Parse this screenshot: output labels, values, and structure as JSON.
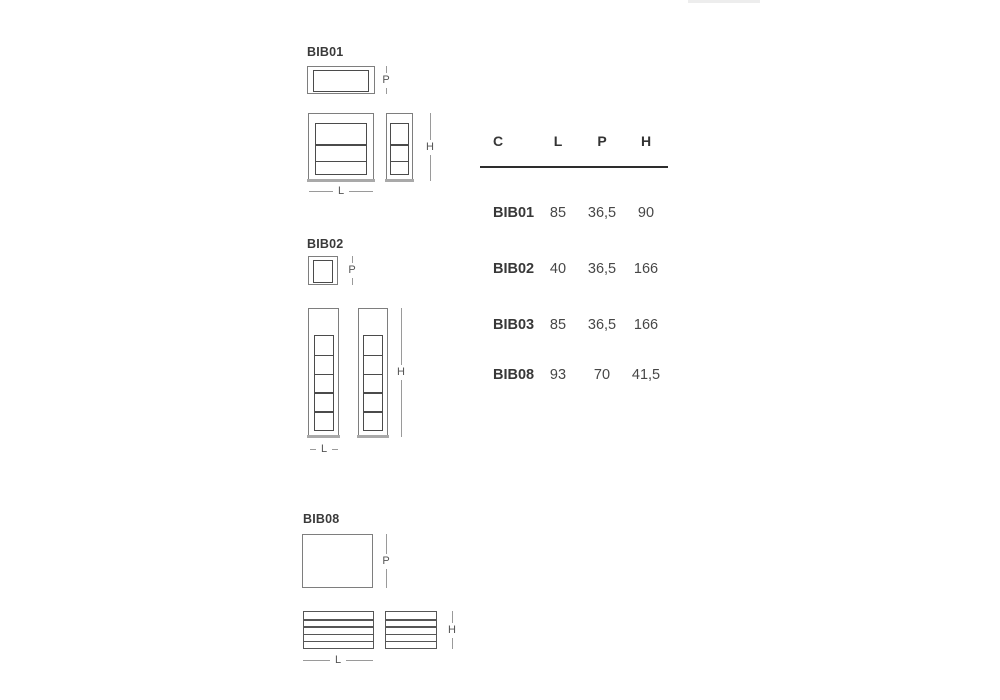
{
  "sections": {
    "bib01": {
      "label": "BIB01",
      "dim_p": "P",
      "dim_h": "H",
      "dim_l": "L"
    },
    "bib02": {
      "label": "BIB02",
      "dim_p": "P",
      "dim_h": "H",
      "dim_l": "L"
    },
    "bib08": {
      "label": "BIB08",
      "dim_p": "P",
      "dim_h": "H",
      "dim_l": "L"
    }
  },
  "table": {
    "headers": [
      "C",
      "L",
      "P",
      "H"
    ],
    "rows": [
      {
        "c": "BIB01",
        "l": "85",
        "p": "36,5",
        "h": "90"
      },
      {
        "c": "BIB02",
        "l": "40",
        "p": "36,5",
        "h": "166"
      },
      {
        "c": "BIB03",
        "l": "85",
        "p": "36,5",
        "h": "166"
      },
      {
        "c": "BIB08",
        "l": "93",
        "p": "70",
        "h": "41,5"
      }
    ]
  },
  "colors": {
    "outer_line": "#7e7e7e",
    "inner_line": "#4b4b4b",
    "dimension_line": "#9a9a9a",
    "text": "#3a3a3a",
    "table_rule": "#2d2d2d"
  }
}
